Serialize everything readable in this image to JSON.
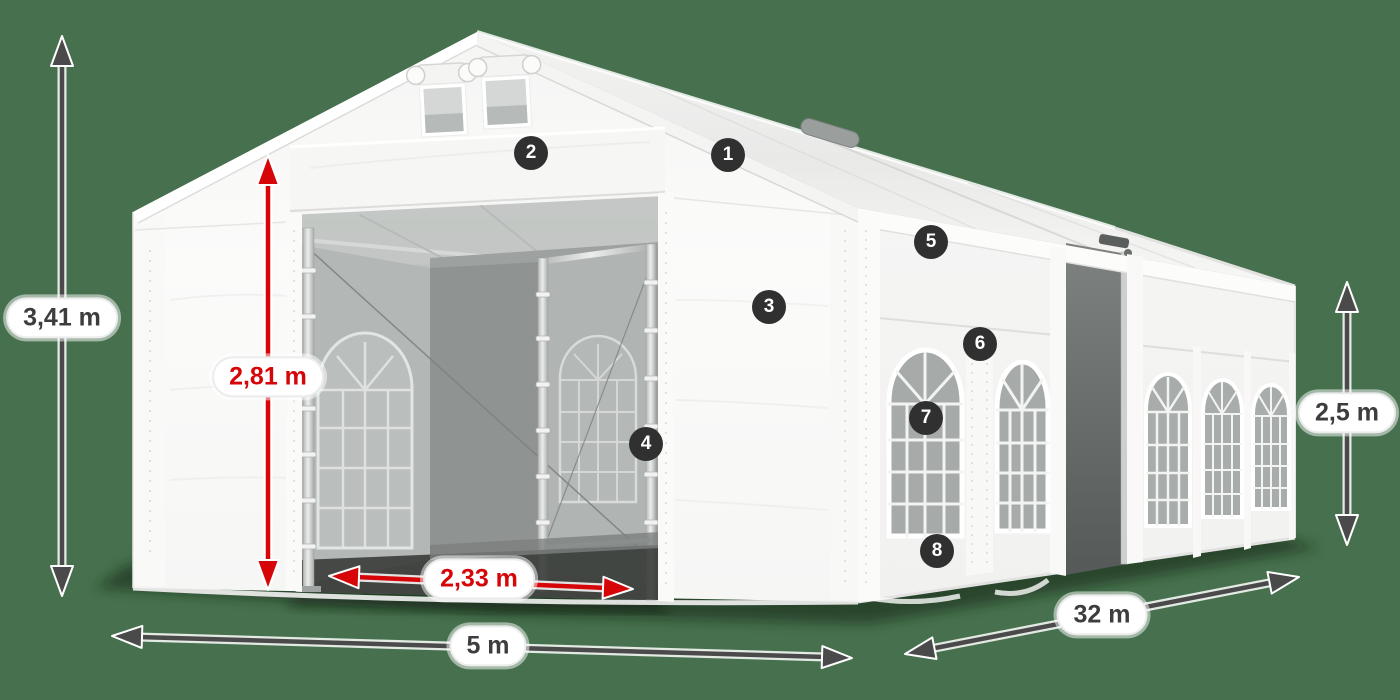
{
  "diagram": {
    "subject": "white marquee tent with dimension measurements and numbered part callouts"
  },
  "dimension_labels": {
    "total_height": "3,41 m",
    "entrance_height": "2,81 m",
    "entrance_width": "2,33 m",
    "tent_width": "5 m",
    "tent_length": "32 m",
    "side_height": "2,5 m"
  },
  "callouts": [
    {
      "number": "1"
    },
    {
      "number": "2"
    },
    {
      "number": "3"
    },
    {
      "number": "4"
    },
    {
      "number": "5"
    },
    {
      "number": "6"
    },
    {
      "number": "7"
    },
    {
      "number": "8"
    }
  ],
  "colors": {
    "background": "#47714E",
    "dimension_red": "#D60508",
    "dimension_dark": "#4A4A4A",
    "badge_bg": "#303030",
    "label_text": "#3D3D3D",
    "tent_white": "#F7F7F7"
  }
}
